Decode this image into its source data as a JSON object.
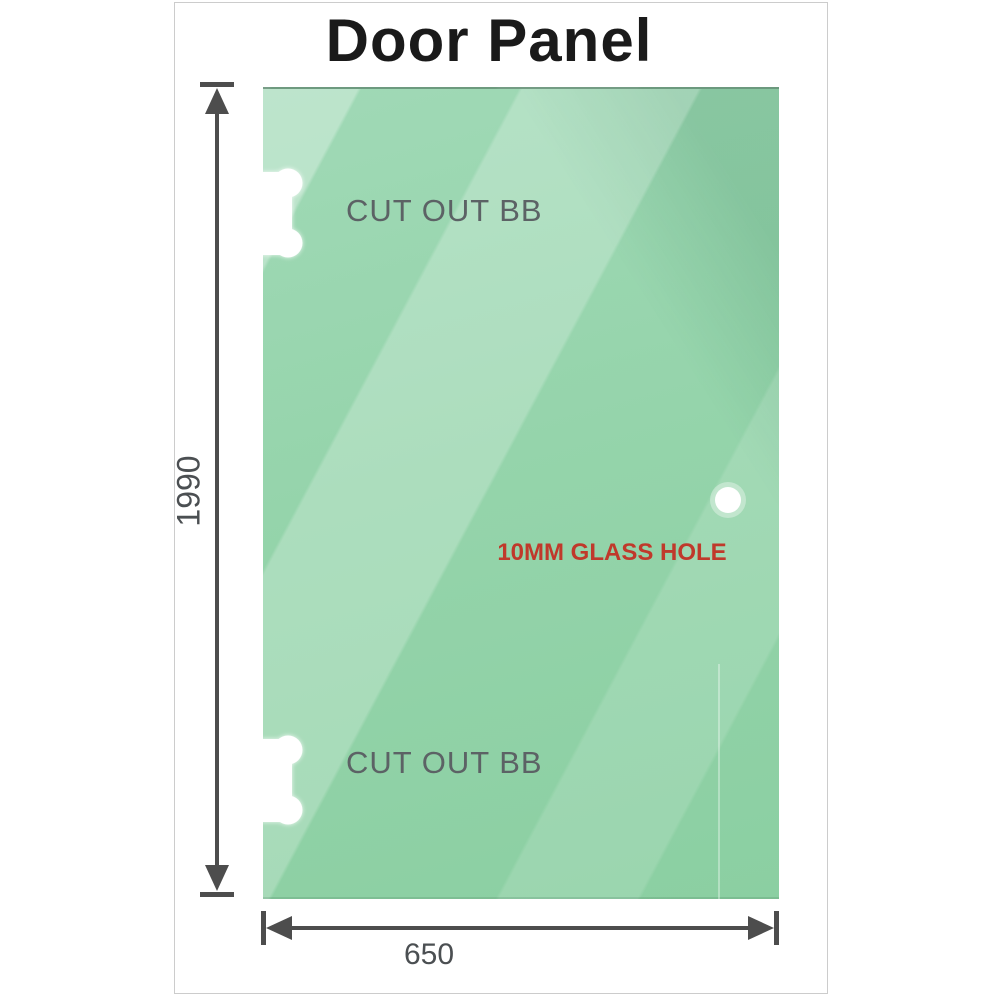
{
  "title": "Door Panel",
  "panel": {
    "cutout_top_label": "CUT OUT BB",
    "cutout_bottom_label": "CUT OUT BB",
    "glass_hole_label": "10MM GLASS HOLE"
  },
  "dimensions": {
    "height_label": "1990",
    "width_label": "650"
  },
  "icons": {
    "cutout_top": "hinge-cutout-icon",
    "cutout_bottom": "hinge-cutout-icon",
    "glass_hole": "circle-hole-icon",
    "height_arrows": "double-arrow-vertical-icon",
    "width_arrows": "double-arrow-horizontal-icon"
  },
  "colors": {
    "glass_green_light": "#aadcbc",
    "glass_green": "#98d5ae",
    "glass_green_dark": "#87cb9e",
    "dimension_gray": "#4d4d4d",
    "cutout_label_gray": "#5c6265",
    "glass_hole_red": "#c0392b",
    "frame_border_gray": "#cccccc",
    "title_black": "#1a1a1a",
    "background_white": "#ffffff"
  }
}
